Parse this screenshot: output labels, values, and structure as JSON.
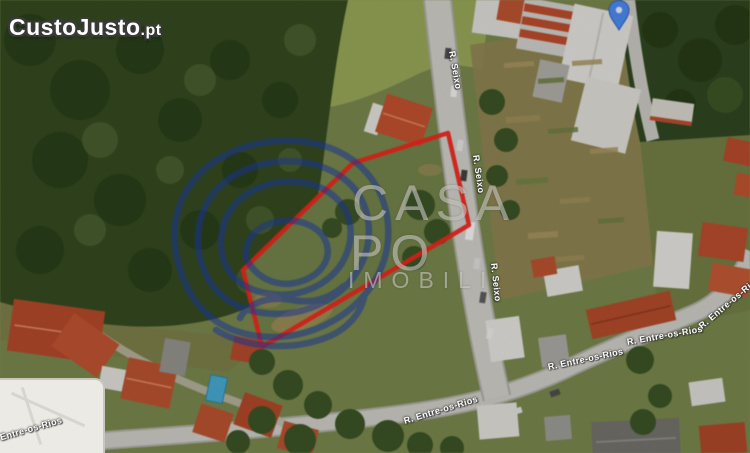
{
  "logo": {
    "brand": "CustoJusto",
    "tld": ".pt"
  },
  "watermark": {
    "line1": "CASA",
    "line2": "PO",
    "line3": "IMOBILI",
    "spiral_color": "#1c3aa8"
  },
  "streets": {
    "seixo": "R. Seixo",
    "entre_os_rios": "R. Entre-os-Rios"
  },
  "map": {
    "view": "satellite",
    "plot_outline_color": "#e7251b",
    "pin_color": "#4a86e8"
  }
}
